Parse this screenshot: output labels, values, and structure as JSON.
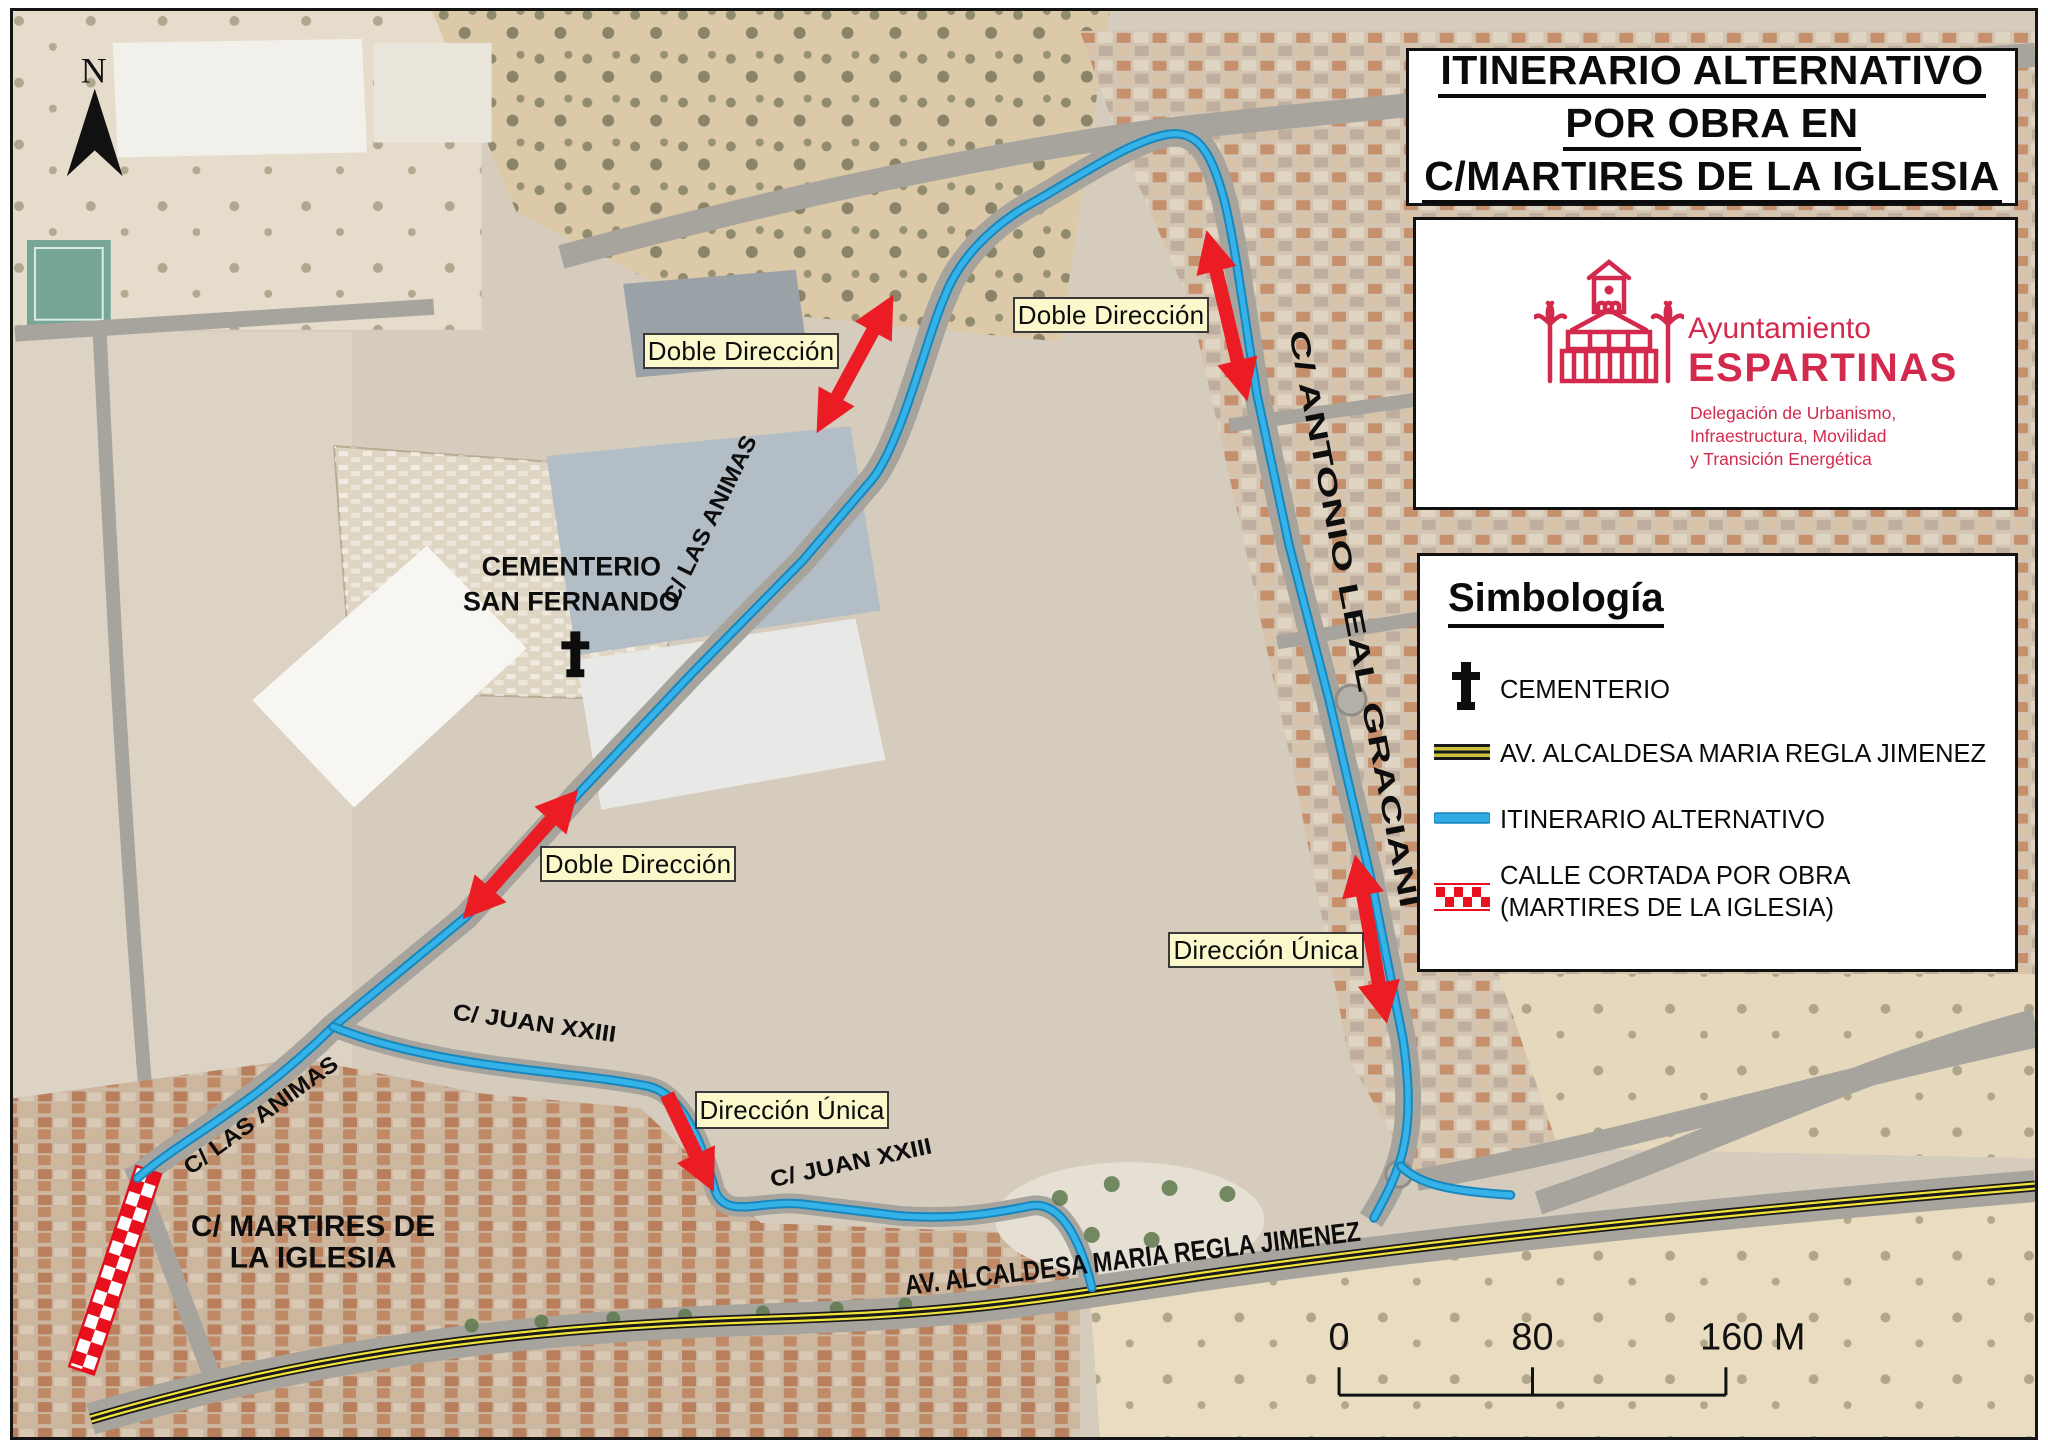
{
  "title": {
    "line1": "ITINERARIO ALTERNATIVO",
    "line2": "POR OBRA EN",
    "line3": "C/MARTIRES DE LA IGLESIA"
  },
  "logo": {
    "org": "Ayuntamiento",
    "municipality": "ESPARTINAS",
    "dept_line1": "Delegación de Urbanismo,",
    "dept_line2": "Infraestructura, Movilidad",
    "dept_line3": "y Transición Energética"
  },
  "legend": {
    "title": "Simbología",
    "item_cementerio": "CEMENTERIO",
    "item_avenida": "AV. ALCALDESA MARIA REGLA JIMENEZ",
    "item_itinerario": "ITINERARIO ALTERNATIVO",
    "item_cortada_1": "CALLE CORTADA POR OBRA",
    "item_cortada_2": "(MARTIRES DE LA IGLESIA)"
  },
  "annotations": {
    "labels": [
      "Doble Dirección",
      "Doble Dirección",
      "Doble Dirección",
      "Dirección Única"
    ]
  },
  "streets": {
    "las_animas": "C/ LAS ANIMAS",
    "juan_xxiii": "C/ JUAN XXIII",
    "antonio_leal": "C/ ANTONIO LEAL GRACIANI",
    "avenida": "AV. ALCALDESA MARIA REGLA JIMENEZ",
    "martires_1": "C/ MARTIRES DE",
    "martires_2": "LA IGLESIA",
    "cementerio_1": "CEMENTERIO",
    "cementerio_2": "SAN FERNANDO"
  },
  "compass": {
    "label": "N"
  },
  "scalebar": {
    "zero": "0",
    "mid": "80",
    "end": "160 M"
  },
  "colors": {
    "route_blue": "#2FAAE3",
    "arrow_red": "#EC1C24",
    "label_yellow": "#FBF9CB",
    "brand_crimson": "#D3294D",
    "road_yellow": "#F2E33A"
  }
}
